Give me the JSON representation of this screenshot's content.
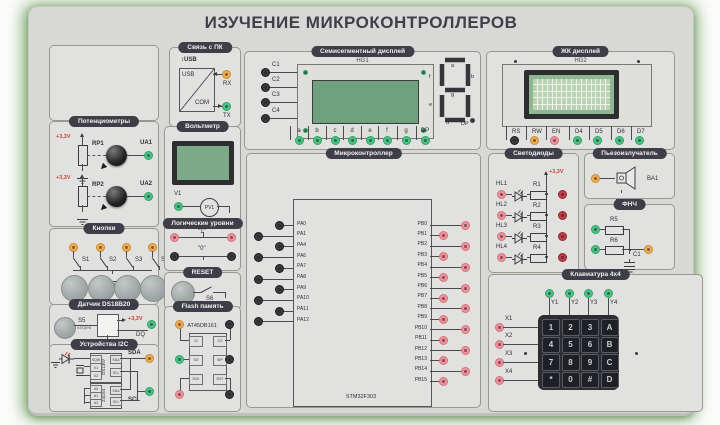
{
  "title": "ИЗУЧЕНИЕ МИКРОКОНТРОЛЛЕРОВ",
  "colors": {
    "accent_green": "#4cc485",
    "accent_orange": "#ecaf55",
    "accent_pink": "#ef929b",
    "accent_red": "#c04048",
    "header_bg": "#3d3e47",
    "vcc_red": "#c84438"
  },
  "pc_link": {
    "title": "Связь с ПК",
    "usb_port": "↕USB",
    "usb": "USB",
    "com": "COM",
    "rx": "RX",
    "tx": "TX"
  },
  "seven_seg": {
    "title": "Семисегментный дисплей",
    "ref": "HG1",
    "inputs": [
      "C1",
      "C2",
      "C3",
      "C4"
    ],
    "segments": [
      "a",
      "b",
      "c",
      "d",
      "e",
      "f",
      "g",
      "DP"
    ],
    "digit": {
      "a": "a",
      "b": "b",
      "c": "c",
      "d": "d",
      "e": "e",
      "f": "f",
      "g": "g",
      "dp": "DP"
    }
  },
  "lcd": {
    "title": "ЖК дисплей",
    "ref": "HG2",
    "pins": [
      {
        "label": "RS",
        "color": "black"
      },
      {
        "label": "RW",
        "color": "orange"
      },
      {
        "label": "EN",
        "color": "pink"
      },
      {
        "label": "D4",
        "color": "green"
      },
      {
        "label": "D5",
        "color": "green"
      },
      {
        "label": "D6",
        "color": "green"
      },
      {
        "label": "D7",
        "color": "green"
      }
    ]
  },
  "pots": {
    "title": "Потенциометры",
    "rows": [
      {
        "vcc": "+3,3V",
        "rp": "RP1",
        "ua": "UA1"
      },
      {
        "vcc": "+3,3V",
        "rp": "RP2",
        "ua": "UA2"
      }
    ]
  },
  "voltmeter": {
    "title": "Вольтметр",
    "input": "V1",
    "meter": "PV1"
  },
  "buttons": {
    "title": "Кнопки",
    "switches": [
      "S1",
      "S2",
      "S3",
      "S4"
    ]
  },
  "logic": {
    "title": "Логические уровни",
    "high": "\"1\"",
    "low": "\"0\""
  },
  "reset": {
    "title": "RESET",
    "switch": "S6"
  },
  "sensor": {
    "title": "Датчик DS18B20",
    "button": "S5",
    "button_sub": "нагрев",
    "vcc": "+3,3V",
    "pin": "DQ"
  },
  "i2c": {
    "title": "Устройства I2C",
    "sda": "SDA",
    "scl": "SCL",
    "chips": [
      {
        "name": "DS1307",
        "left": [
          "SQW",
          "X1",
          "X2"
        ],
        "right": [
          "SDA",
          "SCL"
        ]
      },
      {
        "name": "24C64",
        "left": [
          "A0",
          "A1",
          "A2"
        ],
        "right": [
          "SDA",
          "SCL"
        ]
      }
    ]
  },
  "flash": {
    "title": "Flash память",
    "chip": "AT45DB161",
    "rows": [
      {
        "left": "SI",
        "right": "CS",
        "lc": "orange",
        "rc": "black"
      },
      {
        "left": "SO",
        "right": "WP",
        "lc": "green",
        "rc": "black"
      },
      {
        "left": "SCK",
        "right": "RST",
        "lc": "pink",
        "rc": "black"
      }
    ]
  },
  "mcu": {
    "title": "Микроконтроллер",
    "chip": "STM32F303",
    "left_pins": [
      "PA0",
      "PA1",
      "PA4",
      "PA6",
      "PA7",
      "PA8",
      "PA9",
      "PA10",
      "PA11",
      "PA12"
    ],
    "right_pins": [
      "PB0",
      "PB1",
      "PB2",
      "PB3",
      "PB4",
      "PB5",
      "PB6",
      "PB7",
      "PB8",
      "PB9",
      "PB10",
      "PB11",
      "PB12",
      "PB13",
      "PB14",
      "PB15"
    ]
  },
  "leds": {
    "title": "Светодиоды",
    "vcc": "+3,3V",
    "rows": [
      {
        "hl": "HL1",
        "r": "R1"
      },
      {
        "hl": "HL2",
        "r": "R2"
      },
      {
        "hl": "HL3",
        "r": "R3"
      },
      {
        "hl": "HL4",
        "r": "R4"
      }
    ]
  },
  "buzzer": {
    "title": "Пьезоизлучатель",
    "ref": "BA1"
  },
  "filter": {
    "title": "ФНЧ",
    "r_top": "R5",
    "r_bottom": "R6",
    "cap": "C1"
  },
  "keypad": {
    "title": "Клавиатура 4x4",
    "cols": [
      "Y1",
      "Y2",
      "Y3",
      "Y4"
    ],
    "rows": [
      "X1",
      "X2",
      "X3",
      "X4"
    ],
    "keys": [
      "1",
      "2",
      "3",
      "A",
      "4",
      "5",
      "6",
      "B",
      "7",
      "8",
      "9",
      "C",
      "*",
      "0",
      "#",
      "D"
    ]
  }
}
